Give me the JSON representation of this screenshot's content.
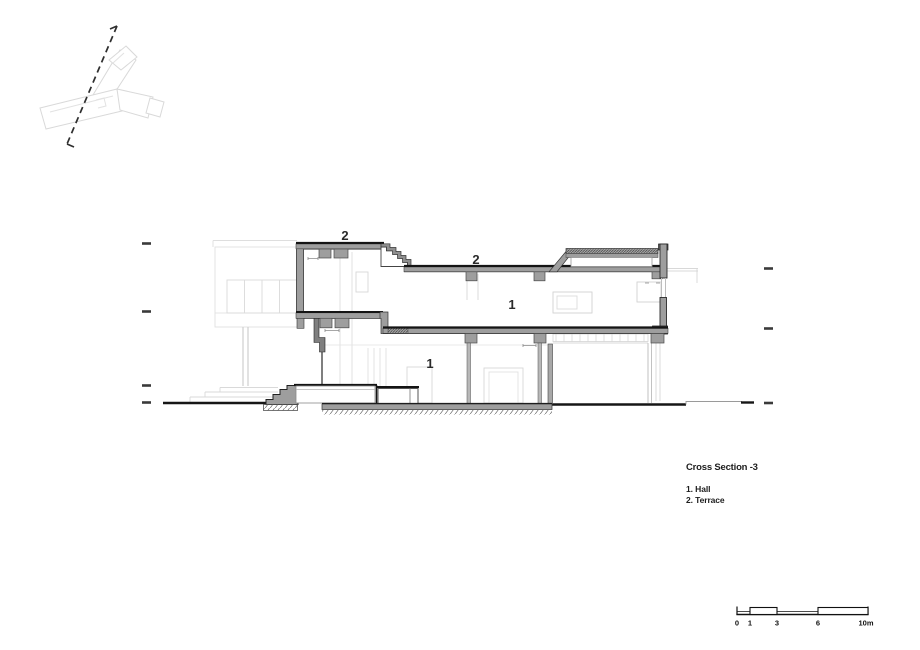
{
  "drawing": {
    "type": "architectural-cross-section",
    "room_labels": [
      {
        "text": "2",
        "meaning": "Terrace"
      },
      {
        "text": "2",
        "meaning": "Terrace"
      },
      {
        "text": "1",
        "meaning": "Hall"
      },
      {
        "text": "1",
        "meaning": "Hall"
      }
    ]
  },
  "title_block": {
    "title": "Cross Section -3",
    "legend": [
      "1. Hall",
      "2. Terrace"
    ]
  },
  "scale_bar": {
    "marks": [
      "0",
      "1",
      "3",
      "6",
      "10m"
    ]
  },
  "colors": {
    "paper": "#ffffff",
    "poche_gray": "#9e9e9e",
    "heavy_line": "#141414",
    "background_line": "#dcdcdc",
    "text": "#1d1d1d"
  }
}
